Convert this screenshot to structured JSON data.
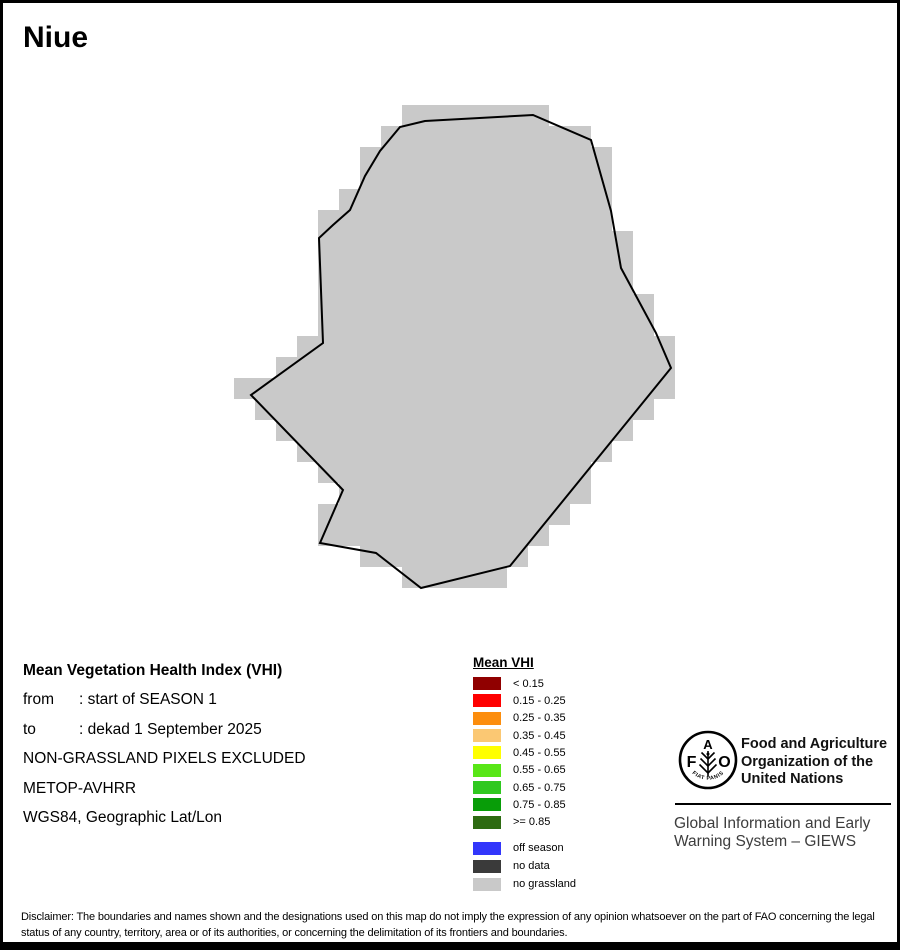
{
  "title": "Niue",
  "map": {
    "fill_color": "#c9c9c9",
    "outline_color": "#000000",
    "cell_size": 21,
    "grid_offset_y": -3,
    "polygon": [
      [
        422,
        118
      ],
      [
        397,
        124
      ],
      [
        377,
        148
      ],
      [
        362,
        173
      ],
      [
        347,
        207
      ],
      [
        330,
        222
      ],
      [
        316,
        235
      ],
      [
        320,
        340
      ],
      [
        248,
        392
      ],
      [
        340,
        487
      ],
      [
        317,
        540
      ],
      [
        373,
        550
      ],
      [
        418,
        585
      ],
      [
        507,
        563
      ],
      [
        668,
        365
      ],
      [
        653,
        330
      ],
      [
        618,
        265
      ],
      [
        608,
        208
      ],
      [
        588,
        137
      ],
      [
        530,
        112
      ]
    ]
  },
  "info": {
    "heading": "Mean Vegetation Health Index (VHI)",
    "rows": [
      {
        "label": "from",
        "value": ": start of SEASON 1"
      },
      {
        "label": "to",
        "value": ": dekad 1 September 2025"
      },
      {
        "label": "",
        "value": "NON-GRASSLAND PIXELS EXCLUDED"
      },
      {
        "label": "",
        "value": "METOP-AVHRR"
      },
      {
        "label": "",
        "value": "WGS84, Geographic Lat/Lon"
      }
    ]
  },
  "legend": {
    "title": "Mean VHI",
    "classes": [
      {
        "label": "< 0.15",
        "color": "#900000"
      },
      {
        "label": "0.15 - 0.25",
        "color": "#fe0000"
      },
      {
        "label": "0.25 - 0.35",
        "color": "#fc8d0d"
      },
      {
        "label": "0.35 - 0.45",
        "color": "#fbc873"
      },
      {
        "label": "0.45 - 0.55",
        "color": "#ffff00"
      },
      {
        "label": "0.55 - 0.65",
        "color": "#58e617"
      },
      {
        "label": "0.65 - 0.75",
        "color": "#2fc81f"
      },
      {
        "label": "0.75 - 0.85",
        "color": "#089d08"
      },
      {
        "label": ">= 0.85",
        "color": "#2e6b12"
      }
    ],
    "extras": [
      {
        "label": "off season",
        "color": "#3236fb"
      },
      {
        "label": "no data",
        "color": "#3a3a3a"
      },
      {
        "label": "no grassland",
        "color": "#c9c9c9"
      }
    ]
  },
  "org": {
    "logo_letter_f": "F",
    "logo_letter_a": "A",
    "logo_letter_o": "O",
    "motto": "FIAT PANIS",
    "name_lines": [
      "Food and Agriculture",
      "Organization of the",
      "United Nations"
    ],
    "subtitle_lines": [
      "Global Information and Early",
      "Warning System – GIEWS"
    ]
  },
  "disclaimer": "Disclaimer: The boundaries and names shown and the designations used on this map do not imply the expression of any opinion whatsoever on the part of FAO concerning the legal status of any country, territory, area or of its authorities, or concerning the delimitation of its frontiers and boundaries."
}
